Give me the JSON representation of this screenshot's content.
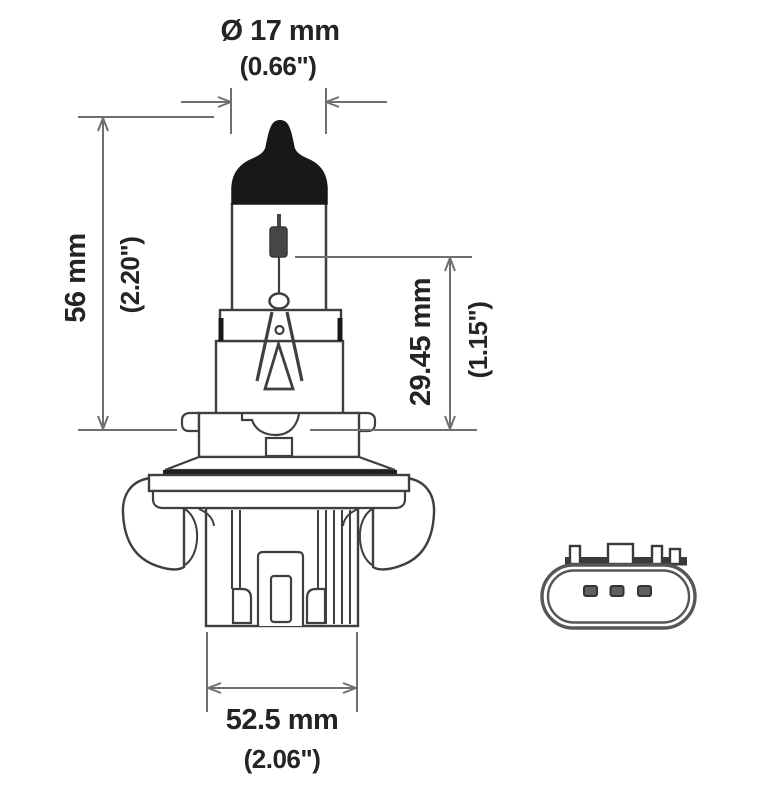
{
  "figure": {
    "subject": "Halogen headlight bulb technical line drawing with rear connector view",
    "view_front": "bulb profile with dimension callouts",
    "view_rear": "connector face with three pins"
  },
  "dimensions": {
    "diameter": {
      "metric": "Ø 17 mm",
      "imperial": "(0.66\")"
    },
    "overall_height": {
      "metric": "56 mm",
      "imperial": "(2.20\")"
    },
    "filament_height": {
      "metric": "29.45 mm",
      "imperial": "(1.15\")"
    },
    "base_width": {
      "metric": "52.5 mm",
      "imperial": "(2.06\")"
    }
  },
  "colors": {
    "background": "#ffffff",
    "outline": "#3f3f3f",
    "dimension_lines": "#6f6f6f",
    "text": "#242424",
    "black_fill": "#181818",
    "filament_fill": "#464646",
    "connector_band": "#3a3a3a",
    "pin_fill": "#5f5f5f"
  }
}
